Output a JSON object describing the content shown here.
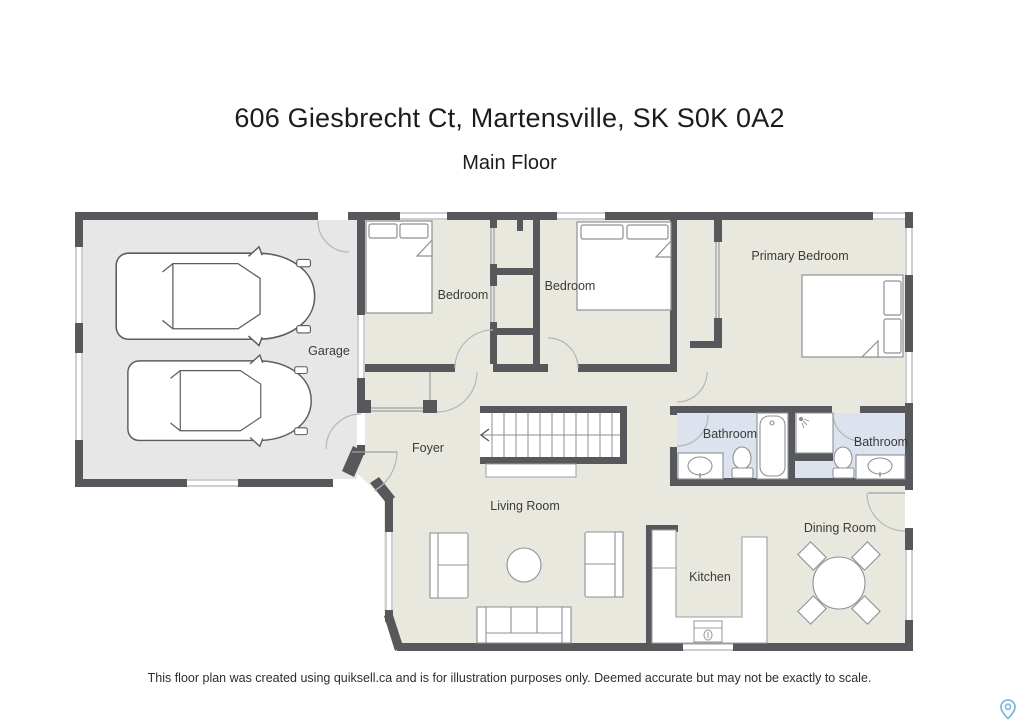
{
  "header": {
    "title": "606 Giesbrecht Ct, Martensville, SK S0K 0A2",
    "subtitle": "Main Floor"
  },
  "rooms": {
    "garage": "Garage",
    "bedroom1": "Bedroom",
    "bedroom2": "Bedroom",
    "primary": "Primary Bedroom",
    "foyer": "Foyer",
    "living": "Living Room",
    "bathroom1": "Bathroom",
    "bathroom2": "Bathroom",
    "kitchen": "Kitchen",
    "dining": "Dining Room"
  },
  "footer": {
    "disclaimer": "This floor plan was created using quiksell.ca and is for illustration purposes only. Deemed accurate but may not be exactly to scale."
  },
  "icons": {
    "map_pin": "map-pin-icon"
  },
  "colors": {
    "wall": "#56585b",
    "floor": "#e9e8df",
    "garage_floor": "#e7e7e7",
    "bathroom_floor": "#dce3ee",
    "pin": "#7db9d8"
  }
}
